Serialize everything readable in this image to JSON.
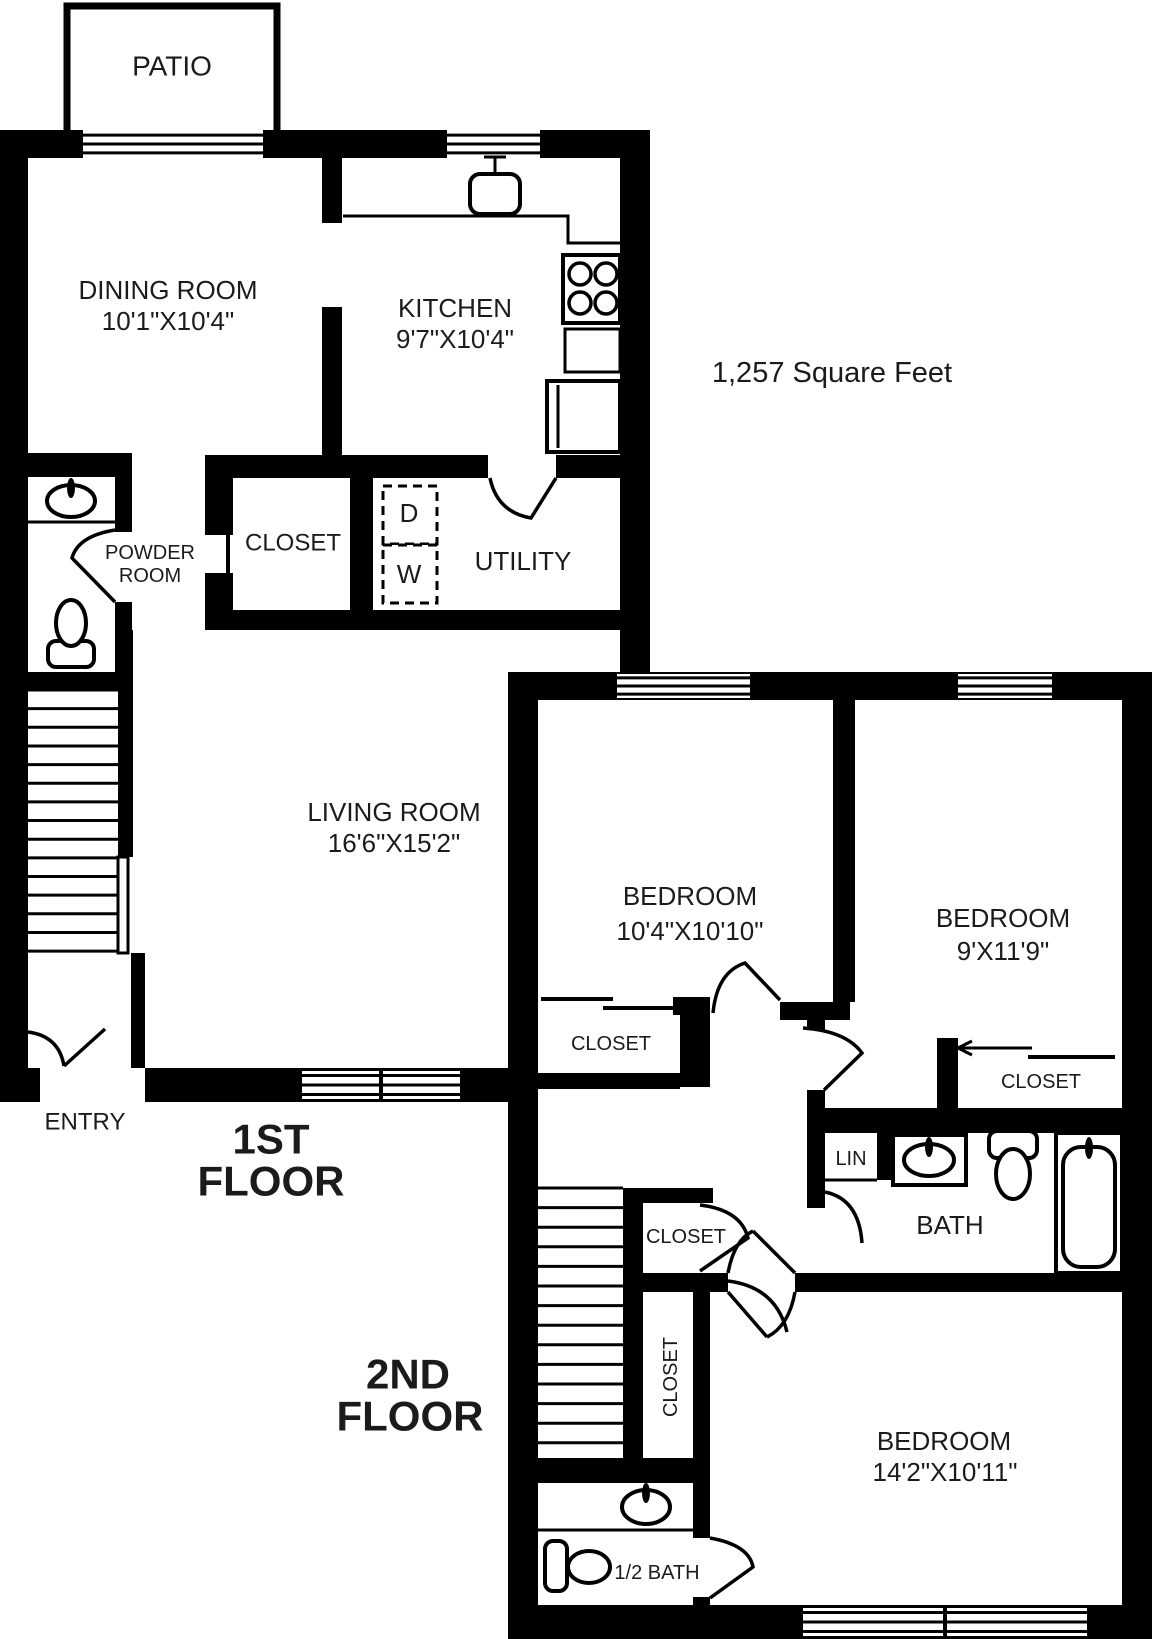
{
  "page": {
    "background": "#ffffff",
    "ink": "#000000",
    "text_color": "#1b1b1b"
  },
  "area_note": "1,257 Square Feet",
  "floor_titles": [
    "1ST FLOOR",
    "2ND FLOOR"
  ],
  "rooms": [
    {
      "name": "PATIO"
    },
    {
      "name": "DINING ROOM",
      "dims": "10'1\"X10'4\""
    },
    {
      "name": "KITCHEN",
      "dims": "9'7\"X10'4\""
    },
    {
      "name": "POWDER ROOM"
    },
    {
      "name": "CLOSET"
    },
    {
      "name": "UTILITY"
    },
    {
      "name": "LIVING ROOM",
      "dims": "16'6\"X15'2\""
    },
    {
      "name": "ENTRY"
    },
    {
      "name": "BEDROOM",
      "dims": "10'4\"X10'10\""
    },
    {
      "name": "BEDROOM",
      "dims": "9'X11'9\""
    },
    {
      "name": "BEDROOM",
      "dims": "14'2\"X10'11\""
    },
    {
      "name": "BATH"
    },
    {
      "name": "1/2 BATH"
    },
    {
      "name": "LIN"
    }
  ],
  "labels": [
    {
      "id": "patio",
      "text": "PATIO",
      "x": 172,
      "y": 66,
      "size": 28
    },
    {
      "id": "dining-room",
      "text": "DINING ROOM",
      "x": 168,
      "y": 290,
      "size": 26
    },
    {
      "id": "dining-room-dims",
      "text": "10'1\"X10'4\"",
      "x": 168,
      "y": 321,
      "size": 26
    },
    {
      "id": "kitchen",
      "text": "KITCHEN",
      "x": 455,
      "y": 308,
      "size": 26
    },
    {
      "id": "kitchen-dims",
      "text": "9'7\"X10'4\"",
      "x": 455,
      "y": 339,
      "size": 26
    },
    {
      "id": "square-feet",
      "text": "1,257 Square Feet",
      "x": 832,
      "y": 373,
      "size": 29
    },
    {
      "id": "closet-1st",
      "text": "CLOSET",
      "x": 293,
      "y": 543,
      "size": 24
    },
    {
      "id": "powder-room-line1",
      "text": "POWDER",
      "x": 150,
      "y": 553,
      "size": 20
    },
    {
      "id": "powder-room-line2",
      "text": "ROOM",
      "x": 150,
      "y": 576,
      "size": 20
    },
    {
      "id": "dryer",
      "text": "D",
      "x": 409,
      "y": 513,
      "size": 26
    },
    {
      "id": "washer",
      "text": "W",
      "x": 409,
      "y": 574,
      "size": 26
    },
    {
      "id": "utility",
      "text": "UTILITY",
      "x": 523,
      "y": 561,
      "size": 26
    },
    {
      "id": "living-room",
      "text": "LIVING ROOM",
      "x": 394,
      "y": 812,
      "size": 26
    },
    {
      "id": "living-room-dims",
      "text": "16'6\"X15'2\"",
      "x": 394,
      "y": 843,
      "size": 26
    },
    {
      "id": "bedroom-1",
      "text": "BEDROOM",
      "x": 690,
      "y": 896,
      "size": 26
    },
    {
      "id": "bedroom-1-dims",
      "text": "10'4\"X10'10\"",
      "x": 690,
      "y": 931,
      "size": 26
    },
    {
      "id": "bedroom-2",
      "text": "BEDROOM",
      "x": 1003,
      "y": 918,
      "size": 26
    },
    {
      "id": "bedroom-2-dims",
      "text": "9'X11'9\"",
      "x": 1003,
      "y": 951,
      "size": 26
    },
    {
      "id": "closet-bedroom-1",
      "text": "CLOSET",
      "x": 611,
      "y": 1044,
      "size": 20
    },
    {
      "id": "closet-bedroom-2",
      "text": "CLOSET",
      "x": 1041,
      "y": 1082,
      "size": 20
    },
    {
      "id": "entry",
      "text": "ENTRY",
      "x": 85,
      "y": 1122,
      "size": 24
    },
    {
      "id": "first-floor-line1",
      "text": "1ST",
      "x": 271,
      "y": 1139,
      "size": 42,
      "bold": true
    },
    {
      "id": "first-floor-line2",
      "text": "FLOOR",
      "x": 271,
      "y": 1181,
      "size": 42,
      "bold": true
    },
    {
      "id": "lin",
      "text": "LIN",
      "x": 851,
      "y": 1159,
      "size": 20
    },
    {
      "id": "bath",
      "text": "BATH",
      "x": 950,
      "y": 1225,
      "size": 26
    },
    {
      "id": "closet-hall",
      "text": "CLOSET",
      "x": 686,
      "y": 1237,
      "size": 20
    },
    {
      "id": "closet-hall-vertical",
      "text": "CLOSET",
      "x": 671,
      "y": 1377,
      "size": 20,
      "rotate": -90
    },
    {
      "id": "second-floor-line1",
      "text": "2ND",
      "x": 408,
      "y": 1374,
      "size": 42,
      "bold": true
    },
    {
      "id": "second-floor-line2",
      "text": "FLOOR",
      "x": 410,
      "y": 1416,
      "size": 42,
      "bold": true
    },
    {
      "id": "bedroom-3",
      "text": "BEDROOM",
      "x": 944,
      "y": 1441,
      "size": 26
    },
    {
      "id": "bedroom-3-dims",
      "text": "14'2\"X10'11\"",
      "x": 945,
      "y": 1472,
      "size": 26
    },
    {
      "id": "half-bath",
      "text": "1/2 BATH",
      "x": 657,
      "y": 1573,
      "size": 20
    }
  ],
  "geometry": {
    "patio_outline": {
      "d": "M 67 131 L 67 6 L 277 6 L 277 131",
      "sw": 7
    },
    "walls": [
      [
        0,
        130,
        83,
        28
      ],
      [
        263,
        130,
        184,
        28
      ],
      [
        540,
        130,
        110,
        28
      ],
      [
        620,
        130,
        30,
        542
      ],
      [
        0,
        130,
        28,
        938
      ],
      [
        322,
        158,
        20,
        65
      ],
      [
        322,
        307,
        20,
        148
      ],
      [
        205,
        455,
        283,
        23
      ],
      [
        556,
        455,
        64,
        23
      ],
      [
        205,
        478,
        28,
        57
      ],
      [
        205,
        573,
        28,
        37
      ],
      [
        350,
        478,
        23,
        132
      ],
      [
        205,
        610,
        445,
        20
      ],
      [
        25,
        453,
        107,
        24
      ],
      [
        115,
        477,
        17,
        55
      ],
      [
        115,
        602,
        17,
        70
      ],
      [
        25,
        672,
        95,
        18
      ],
      [
        118,
        630,
        15,
        227
      ],
      [
        131,
        953,
        14,
        115
      ],
      [
        0,
        1068,
        40,
        34
      ],
      [
        145,
        1068,
        375,
        34
      ],
      [
        508,
        672,
        644,
        28
      ],
      [
        508,
        700,
        30,
        905
      ],
      [
        1122,
        700,
        30,
        905
      ],
      [
        508,
        1605,
        644,
        34
      ],
      [
        833,
        700,
        22,
        302
      ],
      [
        673,
        997,
        37,
        18
      ],
      [
        780,
        1002,
        70,
        18
      ],
      [
        807,
        1020,
        18,
        10
      ],
      [
        680,
        1015,
        30,
        72
      ],
      [
        538,
        1073,
        142,
        16
      ],
      [
        623,
        1188,
        20,
        282
      ],
      [
        623,
        1188,
        90,
        15
      ],
      [
        623,
        1273,
        105,
        19
      ],
      [
        795,
        1273,
        329,
        19
      ],
      [
        693,
        1273,
        17,
        265
      ],
      [
        693,
        1597,
        17,
        13
      ],
      [
        538,
        1458,
        172,
        25
      ],
      [
        807,
        1090,
        18,
        118
      ],
      [
        825,
        1108,
        299,
        25
      ],
      [
        877,
        1133,
        16,
        47
      ],
      [
        937,
        1038,
        21,
        72
      ]
    ],
    "windows": [
      {
        "id": "patio-sliding-door",
        "x": 83,
        "y": 131,
        "w": 180,
        "h": 26
      },
      {
        "id": "kitchen-window",
        "x": 447,
        "y": 131,
        "w": 93,
        "h": 26
      },
      {
        "id": "bedroom-1-window",
        "x": 617,
        "y": 674,
        "w": 133,
        "h": 24
      },
      {
        "id": "bedroom-2-window",
        "x": 958,
        "y": 674,
        "w": 94,
        "h": 24
      },
      {
        "id": "living-room-window-left",
        "x": 302,
        "y": 1071,
        "w": 77,
        "h": 28
      },
      {
        "id": "living-room-window-right",
        "x": 383,
        "y": 1071,
        "w": 77,
        "h": 28
      },
      {
        "id": "bedroom-3-window-left",
        "x": 803,
        "y": 1608,
        "w": 140,
        "h": 28
      },
      {
        "id": "bedroom-3-window-right",
        "x": 947,
        "y": 1608,
        "w": 140,
        "h": 28
      }
    ],
    "doors": [
      {
        "id": "entry-door",
        "d": "M 28 1032 Q 59 1036 64 1066 M 64 1066 L 105 1029"
      },
      {
        "id": "powder-room-door",
        "d": "M 115 530 Q 78 536 72 558 L 115 602"
      },
      {
        "id": "utility-door",
        "d": "M 490 478 Q 497 512 531 518 L 556 478"
      },
      {
        "id": "bedroom-1-door",
        "d": "M 713 1013 Q 717 972 745 963 L 780 1000"
      },
      {
        "id": "bedroom-2-door",
        "d": "M 803 1028 Q 846 1031 862 1053 L 824 1090"
      },
      {
        "id": "bath-door",
        "d": "M 825 1192 Q 859 1199 862 1243"
      },
      {
        "id": "hall-closet-door",
        "d": "M 700 1205 Q 741 1210 748 1238 L 700 1271"
      },
      {
        "id": "hall-door",
        "d": "M 728 1281 Q 776 1287 787 1332"
      },
      {
        "id": "bedroom-3-door",
        "d": "M 795 1292 Q 789 1326 767 1337 M 728 1292 L 767 1337"
      },
      {
        "id": "hall-upper-door",
        "d": "M 728 1273 Q 734 1240 753 1231 M 795 1273 L 753 1231"
      },
      {
        "id": "half-bath-door",
        "d": "M 710 1538 Q 749 1545 753 1567 L 710 1598"
      }
    ],
    "lines": [
      {
        "id": "kitchen-counter",
        "pts": [
          [
            343,
            216
          ],
          [
            568,
            216
          ],
          [
            568,
            243
          ],
          [
            620,
            243
          ]
        ],
        "sw": 3
      },
      {
        "id": "powder-counter",
        "pts": [
          [
            27,
            522
          ],
          [
            115,
            522
          ]
        ],
        "sw": 3
      },
      {
        "id": "closet-1st-door-panel",
        "pts": [
          [
            228,
            533
          ],
          [
            228,
            573
          ]
        ],
        "sw": 4
      },
      {
        "id": "closet-bedroom-1-slider-a",
        "pts": [
          [
            541,
            999
          ],
          [
            613,
            999
          ]
        ],
        "sw": 4
      },
      {
        "id": "closet-bedroom-1-slider-b",
        "pts": [
          [
            603,
            1008
          ],
          [
            673,
            1008
          ]
        ],
        "sw": 4
      },
      {
        "id": "closet-bedroom-2-slider-a",
        "pts": [
          [
            958,
            1048
          ],
          [
            1032,
            1048
          ]
        ],
        "sw": 3
      },
      {
        "id": "closet-bedroom-2-arrow-1",
        "pts": [
          [
            958,
            1048
          ],
          [
            972,
            1041
          ]
        ],
        "sw": 3
      },
      {
        "id": "closet-bedroom-2-arrow-2",
        "pts": [
          [
            958,
            1048
          ],
          [
            972,
            1055
          ]
        ],
        "sw": 3
      },
      {
        "id": "closet-bedroom-2-slider-b",
        "pts": [
          [
            1028,
            1057
          ],
          [
            1115,
            1057
          ]
        ],
        "sw": 4
      },
      {
        "id": "lin-shelf",
        "pts": [
          [
            823,
            1180
          ],
          [
            877,
            1180
          ]
        ],
        "sw": 3
      },
      {
        "id": "half-bath-vanity-edge",
        "pts": [
          [
            538,
            1530
          ],
          [
            693,
            1530
          ]
        ],
        "sw": 3
      },
      {
        "id": "oven-door-line",
        "pts": [
          [
            614,
            259
          ],
          [
            614,
            321
          ]
        ],
        "sw": 3
      }
    ],
    "stairs": [
      {
        "id": "stairs-first-floor",
        "x": 27,
        "y": 690,
        "w": 91,
        "count": 15,
        "step": 18.65
      },
      {
        "id": "stairs-second-floor",
        "x": 538,
        "y": 1188,
        "w": 85,
        "count": 15,
        "step": 19.6
      }
    ],
    "dashed_boxes": [
      {
        "id": "dryer-box",
        "x": 383,
        "y": 486,
        "w": 54,
        "h": 58
      },
      {
        "id": "washer-box",
        "x": 383,
        "y": 545,
        "w": 54,
        "h": 58
      }
    ],
    "fixtures": [
      {
        "id": "kitchen-sink",
        "shapes": [
          {
            "t": "rrect",
            "x": 470,
            "y": 174,
            "w": 50,
            "h": 40,
            "r": 10,
            "sw": 4
          },
          {
            "t": "line",
            "x1": 495,
            "y1": 174,
            "x2": 495,
            "y2": 158,
            "sw": 3
          },
          {
            "t": "line",
            "x1": 484,
            "y1": 157,
            "x2": 506,
            "y2": 157,
            "sw": 3
          }
        ]
      },
      {
        "id": "stove",
        "shapes": [
          {
            "t": "rect",
            "x": 563,
            "y": 255,
            "w": 57,
            "h": 68,
            "sw": 4
          },
          {
            "t": "circle",
            "cx": 580,
            "cy": 274,
            "r": 11,
            "sw": 3.5
          },
          {
            "t": "circle",
            "cx": 606,
            "cy": 274,
            "r": 11,
            "sw": 3.5
          },
          {
            "t": "circle",
            "cx": 580,
            "cy": 303,
            "r": 11,
            "sw": 3.5
          },
          {
            "t": "circle",
            "cx": 606,
            "cy": 303,
            "r": 11,
            "sw": 3.5
          }
        ]
      },
      {
        "id": "kitchen-counter-cabinet",
        "shapes": [
          {
            "t": "rect",
            "x": 565,
            "y": 329,
            "w": 55,
            "h": 43,
            "sw": 3
          }
        ]
      },
      {
        "id": "dishwasher",
        "shapes": [
          {
            "t": "rect",
            "x": 547,
            "y": 381,
            "w": 73,
            "h": 71,
            "sw": 4
          },
          {
            "t": "line",
            "x1": 558,
            "y1": 385,
            "x2": 558,
            "y2": 448,
            "sw": 3
          }
        ]
      },
      {
        "id": "powder-room-sink",
        "shapes": [
          {
            "t": "ellipse",
            "cx": 71,
            "cy": 501,
            "rx": 24,
            "ry": 16,
            "sw": 4
          },
          {
            "t": "fellipse",
            "cx": 71,
            "cy": 488,
            "rx": 4,
            "ry": 10
          }
        ]
      },
      {
        "id": "powder-room-toilet",
        "shapes": [
          {
            "t": "rrect",
            "x": 48,
            "y": 641,
            "w": 46,
            "h": 26,
            "r": 8,
            "sw": 4
          },
          {
            "t": "ellipse",
            "cx": 71,
            "cy": 623,
            "rx": 15,
            "ry": 23,
            "sw": 4
          }
        ]
      },
      {
        "id": "stair-railing",
        "shapes": [
          {
            "t": "rect",
            "x": 118,
            "y": 857,
            "w": 10,
            "h": 96,
            "sw": 3
          }
        ]
      },
      {
        "id": "bath-vanity-sink",
        "shapes": [
          {
            "t": "rect",
            "x": 893,
            "y": 1135,
            "w": 73,
            "h": 50,
            "sw": 4
          },
          {
            "t": "ellipse",
            "cx": 929,
            "cy": 1160,
            "rx": 25,
            "ry": 16,
            "sw": 4
          },
          {
            "t": "fellipse",
            "cx": 929,
            "cy": 1147,
            "rx": 4,
            "ry": 10
          }
        ]
      },
      {
        "id": "bath-toilet",
        "shapes": [
          {
            "t": "rrect",
            "x": 989,
            "y": 1131,
            "w": 48,
            "h": 27,
            "r": 8,
            "sw": 4
          },
          {
            "t": "ellipse",
            "cx": 1013,
            "cy": 1174,
            "rx": 17,
            "ry": 25,
            "sw": 4
          }
        ]
      },
      {
        "id": "bathtub",
        "shapes": [
          {
            "t": "rect",
            "x": 1056,
            "y": 1133,
            "w": 66,
            "h": 140,
            "sw": 4
          },
          {
            "t": "rrect",
            "x": 1063,
            "y": 1147,
            "w": 52,
            "h": 120,
            "r": 18,
            "sw": 4
          },
          {
            "t": "fellipse",
            "cx": 1089,
            "cy": 1148,
            "rx": 4,
            "ry": 11
          }
        ]
      },
      {
        "id": "half-bath-sink",
        "shapes": [
          {
            "t": "ellipse",
            "cx": 646,
            "cy": 1507,
            "rx": 24,
            "ry": 17,
            "sw": 4
          },
          {
            "t": "fellipse",
            "cx": 646,
            "cy": 1493,
            "rx": 4,
            "ry": 10
          }
        ]
      },
      {
        "id": "half-bath-toilet",
        "shapes": [
          {
            "t": "rrect",
            "x": 545,
            "y": 1541,
            "w": 22,
            "h": 50,
            "r": 8,
            "sw": 4
          },
          {
            "t": "ellipse",
            "cx": 589,
            "cy": 1567,
            "rx": 21,
            "ry": 16,
            "sw": 4
          }
        ]
      }
    ]
  }
}
